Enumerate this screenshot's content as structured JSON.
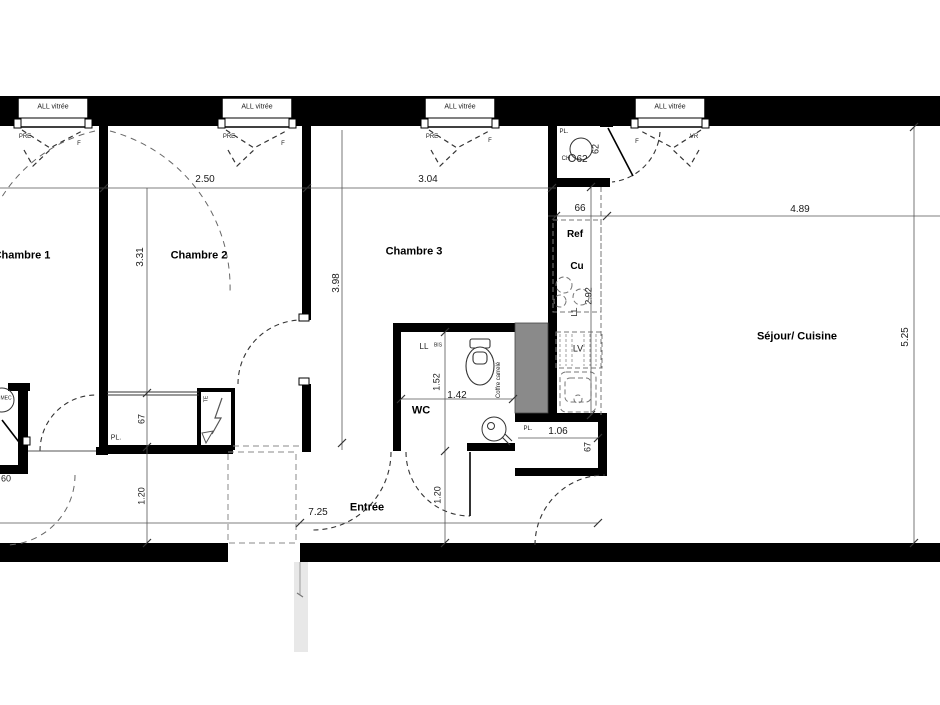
{
  "drawing": {
    "type": "floor-plan",
    "title": "Plan appartement 3 chambres",
    "colors": {
      "wall": "#000000",
      "thin_line": "#555555",
      "dashed": "#444444",
      "furniture_dash": "#777777",
      "coffre_fill": "#8a8a8a",
      "ghost": "#cccccc"
    }
  },
  "labels": [
    {
      "name": "window-1-label",
      "t": "ALL vitrée",
      "x": 53,
      "y": 107,
      "s": 7
    },
    {
      "name": "window-2-label",
      "t": "ALL vitrée",
      "x": 257,
      "y": 107,
      "s": 7
    },
    {
      "name": "window-3-label",
      "t": "ALL vitrée",
      "x": 460,
      "y": 107,
      "s": 7
    },
    {
      "name": "window-4-label",
      "t": "ALL vitrée",
      "x": 670,
      "y": 107,
      "s": 7
    },
    {
      "name": "window-1-pre",
      "t": "PRE",
      "x": 25,
      "y": 137,
      "s": 6
    },
    {
      "name": "window-1-f",
      "t": "F",
      "x": 79,
      "y": 144,
      "s": 6
    },
    {
      "name": "window-2-pre",
      "t": "PRE",
      "x": 229,
      "y": 137,
      "s": 6
    },
    {
      "name": "window-2-f",
      "t": "F",
      "x": 283,
      "y": 144,
      "s": 6
    },
    {
      "name": "window-3-pre",
      "t": "PRE",
      "x": 432,
      "y": 137,
      "s": 6
    },
    {
      "name": "window-3-f",
      "t": "F",
      "x": 490,
      "y": 141,
      "s": 6
    },
    {
      "name": "window-4-f",
      "t": "F",
      "x": 637,
      "y": 142,
      "s": 6
    },
    {
      "name": "window-4-vr",
      "t": "VR",
      "x": 694,
      "y": 137,
      "s": 6
    },
    {
      "name": "room-chambre-1",
      "t": "Chambre 1",
      "x": 22,
      "y": 256,
      "s": 11,
      "bold": 1
    },
    {
      "name": "room-chambre-2",
      "t": "Chambre 2",
      "x": 199,
      "y": 256,
      "s": 11,
      "bold": 1
    },
    {
      "name": "room-chambre-3",
      "t": "Chambre 3",
      "x": 414,
      "y": 252,
      "s": 11,
      "bold": 1
    },
    {
      "name": "room-sejour-cuisine",
      "t": "Séjour/ Cuisine",
      "x": 797,
      "y": 337,
      "s": 11,
      "bold": 1
    },
    {
      "name": "room-entree",
      "t": "Entrée",
      "x": 367,
      "y": 508,
      "s": 11,
      "bold": 1
    },
    {
      "name": "room-wc",
      "t": "WC",
      "x": 421,
      "y": 411,
      "s": 11,
      "bold": 1
    },
    {
      "name": "dim-2-50",
      "t": "2.50",
      "x": 205,
      "y": 180,
      "s": 10
    },
    {
      "name": "dim-3-04",
      "t": "3.04",
      "x": 428,
      "y": 180,
      "s": 10
    },
    {
      "name": "dim-3-31",
      "t": "3.31",
      "x": 141,
      "y": 257,
      "s": 10,
      "rot": 1
    },
    {
      "name": "dim-3-98",
      "t": "3.98",
      "x": 337,
      "y": 283,
      "s": 10,
      "rot": 1
    },
    {
      "name": "dim-4-89",
      "t": "4.89",
      "x": 800,
      "y": 210,
      "s": 10
    },
    {
      "name": "dim-5-25",
      "t": "5.25",
      "x": 906,
      "y": 337,
      "s": 10,
      "rot": 1
    },
    {
      "name": "dim-66",
      "t": "66",
      "x": 580,
      "y": 209,
      "s": 10
    },
    {
      "name": "dim-2-92",
      "t": "2.92",
      "x": 589,
      "y": 296,
      "s": 9,
      "rot": 1
    },
    {
      "name": "label-ll-kitchen",
      "t": "LL",
      "x": 575,
      "y": 312,
      "s": 8,
      "rot": 1
    },
    {
      "name": "label-ref",
      "t": "Ref",
      "x": 575,
      "y": 235,
      "s": 10,
      "bold": 1
    },
    {
      "name": "label-cu",
      "t": "Cu",
      "x": 577,
      "y": 267,
      "s": 10,
      "bold": 1
    },
    {
      "name": "label-lv",
      "t": "LV",
      "x": 578,
      "y": 349,
      "s": 9
    },
    {
      "name": "label-pl-niche",
      "t": "PL.",
      "x": 564,
      "y": 132,
      "s": 6
    },
    {
      "name": "label-ch",
      "t": "CH",
      "x": 566,
      "y": 159,
      "s": 6
    },
    {
      "name": "dim-62",
      "t": "62",
      "x": 582,
      "y": 160,
      "s": 10
    },
    {
      "name": "dim-62-rot",
      "t": "62",
      "x": 596,
      "y": 149,
      "s": 9,
      "rot": 1
    },
    {
      "name": "label-pl-closet-ch2",
      "t": "PL.",
      "x": 116,
      "y": 438,
      "s": 7
    },
    {
      "name": "dim-67-closet-ch2",
      "t": "67",
      "x": 142,
      "y": 419,
      "s": 9,
      "rot": 1
    },
    {
      "name": "dim-1-20-left",
      "t": "1.20",
      "x": 142,
      "y": 496,
      "s": 9,
      "rot": 1
    },
    {
      "name": "dim-7-25",
      "t": "7.25",
      "x": 318,
      "y": 513,
      "s": 10
    },
    {
      "name": "dim-1-20-right",
      "t": "1.20",
      "x": 438,
      "y": 495,
      "s": 9,
      "rot": 1
    },
    {
      "name": "dim-1-52",
      "t": "1.52",
      "x": 437,
      "y": 382,
      "s": 9,
      "rot": 1
    },
    {
      "name": "dim-1-42",
      "t": "1.42",
      "x": 457,
      "y": 396,
      "s": 10
    },
    {
      "name": "label-ll-wc",
      "t": "LL",
      "x": 424,
      "y": 347,
      "s": 8
    },
    {
      "name": "label-bis",
      "t": "BIS",
      "x": 438,
      "y": 346,
      "s": 5
    },
    {
      "name": "label-coffre-carrele",
      "t": "Coffre carrelé",
      "x": 499,
      "y": 380,
      "s": 6,
      "rot": 1
    },
    {
      "name": "label-pl-closet-entree",
      "t": "PL.",
      "x": 528,
      "y": 429,
      "s": 6
    },
    {
      "name": "dim-1-06",
      "t": "1.06",
      "x": 558,
      "y": 432,
      "s": 10
    },
    {
      "name": "dim-67-closet-entree",
      "t": "67",
      "x": 588,
      "y": 447,
      "s": 9,
      "rot": 1
    },
    {
      "name": "label-mec",
      "t": "MEC",
      "x": 6,
      "y": 399,
      "s": 5
    },
    {
      "name": "dim-60",
      "t": "60",
      "x": 6,
      "y": 479,
      "s": 9
    },
    {
      "name": "label-te",
      "t": "TE",
      "x": 207,
      "y": 399,
      "s": 5,
      "rot": 1
    }
  ]
}
